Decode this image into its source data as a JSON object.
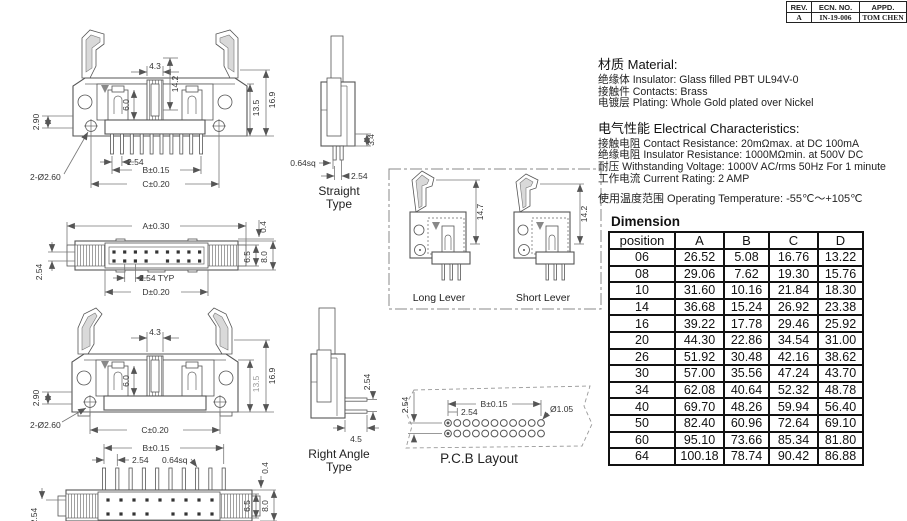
{
  "revision_table": {
    "headers": [
      "REV.",
      "ECN. NO.",
      "APPD."
    ],
    "row": {
      "rev": "A",
      "ecn_no": "IN-19-006",
      "appd": "TOM CHEN"
    }
  },
  "material": {
    "heading": "材质 Material:",
    "lines": [
      "绝缘体 Insulator: Glass filled PBT UL94V-0",
      "接触件 Contacts: Brass",
      "电镀层 Plating: Whole Gold plated over Nickel"
    ]
  },
  "electrical": {
    "heading": "电气性能 Electrical Characteristics:",
    "lines": [
      "接触电阻 Contact Resistance: 20mΩmax. at DC 100mA",
      "绝缘电阻 Insulator Resistance: 1000MΩmin. at 500V DC",
      "耐压 Withstanding Voltage: 1000V AC/rms 50Hz For 1 minute",
      "工作电流 Current Rating: 2 AMP"
    ],
    "operating_temp": "使用温度范围 Operating Temperature: -55℃～+105℃"
  },
  "dimension_table": {
    "title": "Dimension",
    "headers": [
      "position",
      "A",
      "B",
      "C",
      "D"
    ],
    "rows": [
      [
        "06",
        "26.52",
        "5.08",
        "16.76",
        "13.22"
      ],
      [
        "08",
        "29.06",
        "7.62",
        "19.30",
        "15.76"
      ],
      [
        "10",
        "31.60",
        "10.16",
        "21.84",
        "18.30"
      ],
      [
        "14",
        "36.68",
        "15.24",
        "26.92",
        "23.38"
      ],
      [
        "16",
        "39.22",
        "17.78",
        "29.46",
        "25.92"
      ],
      [
        "20",
        "44.30",
        "22.86",
        "34.54",
        "31.00"
      ],
      [
        "26",
        "51.92",
        "30.48",
        "42.16",
        "38.62"
      ],
      [
        "30",
        "57.00",
        "35.56",
        "47.24",
        "43.70"
      ],
      [
        "34",
        "62.08",
        "40.64",
        "52.32",
        "48.78"
      ],
      [
        "40",
        "69.70",
        "48.26",
        "59.94",
        "56.40"
      ],
      [
        "50",
        "82.40",
        "60.96",
        "72.64",
        "69.10"
      ],
      [
        "60",
        "95.10",
        "73.66",
        "85.34",
        "81.80"
      ],
      [
        "64",
        "100.18",
        "78.74",
        "90.42",
        "86.88"
      ]
    ]
  },
  "drawings": {
    "front_long": {
      "dims": {
        "key_w": "4.3",
        "latch_h": "14.2",
        "slot_h": "6.0",
        "hole_off": "2.90",
        "body_h": "13.5",
        "total_h": "16.9",
        "holes": "2-Ø2.60",
        "pitch": "2.54",
        "span_b": "B±0.15",
        "span_c": "C±0.20"
      }
    },
    "top_plain": {
      "dims": {
        "span_a": "A±0.30",
        "lip": "0.4",
        "inner_h": "6.5",
        "outer_h": "8.0",
        "row_pitch": "2.54",
        "pitch_typ": "2.54 TYP",
        "span_d": "D±0.20"
      }
    },
    "front_short": {
      "dims": {
        "key_w": "4.3",
        "slot_h": "6.0",
        "hole_off": "2.90",
        "body_h": "13.5",
        "total_h": "16.9",
        "holes": "2-Ø2.60",
        "span_c": "C±0.20"
      }
    },
    "top_pins": {
      "dims": {
        "span_b": "B±0.15",
        "pitch": "2.54",
        "pin_sq": "0.64sq",
        "lip": "0.4",
        "inner_h": "6.5",
        "outer_h": "8.0",
        "row_pitch": "2.54"
      }
    },
    "straight": {
      "caption_lines": [
        "Straight",
        "Type"
      ],
      "dims": {
        "pin_sq": "0.64sq",
        "pitch": "2.54",
        "standoff": "3.4"
      }
    },
    "right_angle": {
      "caption_lines": [
        "Right Angle",
        "Type"
      ],
      "dims": {
        "pitch": "2.54",
        "tail": "4.5"
      }
    },
    "levers": {
      "long_caption": "Long Lever",
      "short_caption": "Short Lever",
      "long_h": "14.7",
      "short_h": "14.2"
    },
    "pcb": {
      "caption": "P.C.B Layout",
      "dims": {
        "row_pitch": "2.54",
        "span_b": "B±0.15",
        "pitch": "2.54",
        "hole_dia": "Ø1.05"
      }
    }
  }
}
